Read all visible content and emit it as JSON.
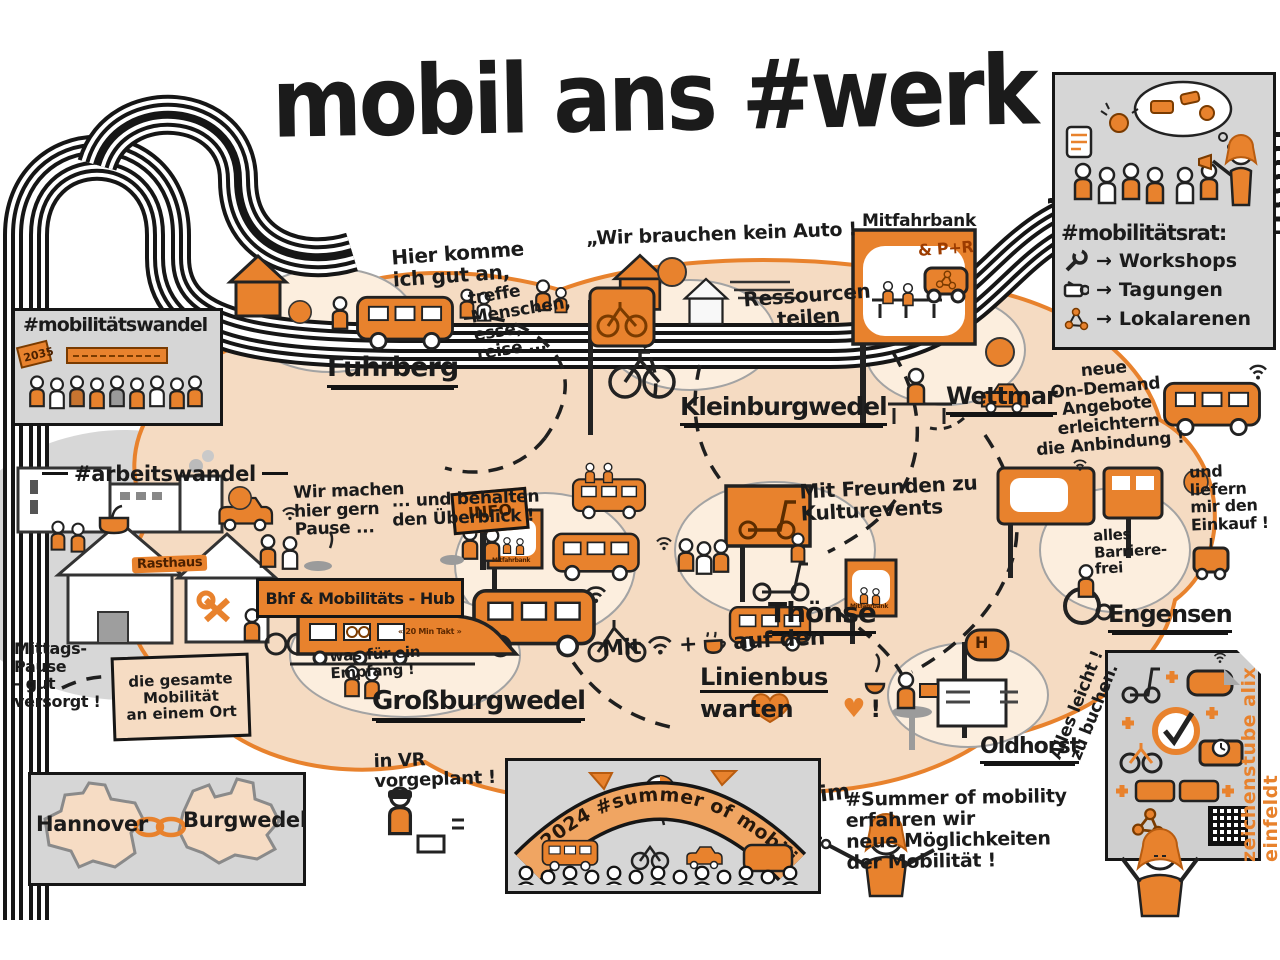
{
  "title": "mobil ans #werk",
  "regions": {
    "fuhrberg": "Fuhrberg",
    "kleinburgwedel": "Kleinburgwedel",
    "wettmar": "Wettmar",
    "thoense": "Thönse",
    "grossburgwedel": "Großburgwedel",
    "engensen": "Engensen",
    "oldhorst": "Oldhorst"
  },
  "boxes": {
    "wandel": {
      "title": "#mobilitätswandel",
      "sign": "2035"
    },
    "arbeit": {
      "title": "#arbeitswandel",
      "rasthaus": "Rasthaus"
    },
    "rat": {
      "title": "#mobilitätsrat:",
      "arrow": "→",
      "items": [
        {
          "icon": "wrench-icon",
          "label": "Workshops"
        },
        {
          "icon": "projector-icon",
          "label": "Tagungen"
        },
        {
          "icon": "network-icon",
          "label": "Lokalarenen"
        }
      ]
    },
    "cities": {
      "left": "Hannover",
      "right": "Burgwedel"
    },
    "stage": {
      "banner": "2024 #summer of mobility"
    }
  },
  "notes": {
    "arrive1": "Hier komme\nich gut an,",
    "arrive2": "treffe\nMenschen,\nesse,\nreise ...",
    "no_car": "„Wir brauchen kein Auto !",
    "ressourcen": "Ressourcen\nteilen",
    "mitfahrbank": "Mitfahrbank",
    "pr": "& P+R",
    "ondemand": "neue\nOn-Demand\nAngebote\nerleichtern\ndie Anbindung !",
    "einkauf": "und liefern\nmir den\nEinkauf !",
    "barrierefrei": "alles\nBarriere-\nfrei",
    "kultur": "Mit Freunden zu\nKulturevents",
    "pause": "Wir machen\nhier gern\nPause ...",
    "oberblick": "... und behalten\nden Überblick !",
    "hub": "Bhf & Mobilitäts - Hub",
    "info": "INFO",
    "mitfahrbank_mini": "Mitfahrbank",
    "empfang": "was für ein\nEmpfang !",
    "gesamt": "die gesamte\nMobilität\nan einem Ort",
    "mittag": "Mittags-\nPause\n- gut\nversorgt !",
    "vr": "in VR\nvorgeplant !",
    "takt": "« 20 Min  Takt »",
    "mit": "Mit",
    "plus": "+",
    "aufden": "auf den",
    "linienbus": "Linienbus",
    "warten": "warten",
    "heart": "♥",
    "excl": "!",
    "im": "im",
    "summer": "#Summer of mobility\nerfahren wir\nneue Möglichkeiten\nder Mobilität !",
    "buchen": "Alles leicht !\nzu buchen.",
    "haltestelle": "H",
    "credit": "zeichenstube alix einfeldt"
  }
}
